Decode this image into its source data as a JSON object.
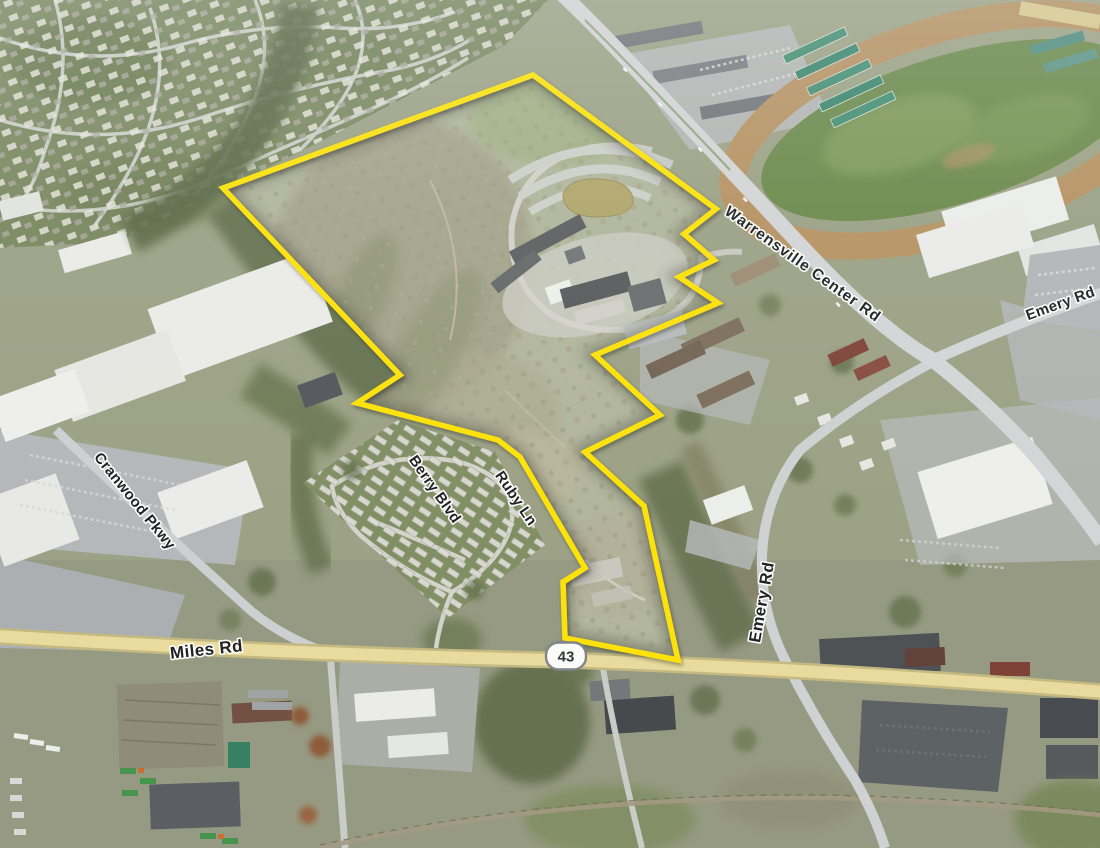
{
  "map": {
    "type": "satellite-aerial-oblique",
    "labels": {
      "warrensville": {
        "text": "Warrensville Center Rd"
      },
      "emery_ne": {
        "text": "Emery Rd"
      },
      "emery_s": {
        "text": "Emery Rd"
      },
      "cranwood": {
        "text": "Cranwood Pkwy"
      },
      "berry": {
        "text": "Berry Blvd"
      },
      "ruby": {
        "text": "Ruby Ln"
      },
      "miles": {
        "text": "Miles Rd"
      }
    },
    "route_shield": {
      "number": "43",
      "fill": "#fdfdfa",
      "border": "#7c8186"
    },
    "parcel": {
      "outline_color": "#FFE300",
      "points": "533,75 716,209 684,234 714,260 679,277 718,303 595,355 660,415 585,452 644,506 678,660 565,638 563,582 585,568 520,457 498,440 357,403 400,375 223,188"
    }
  }
}
